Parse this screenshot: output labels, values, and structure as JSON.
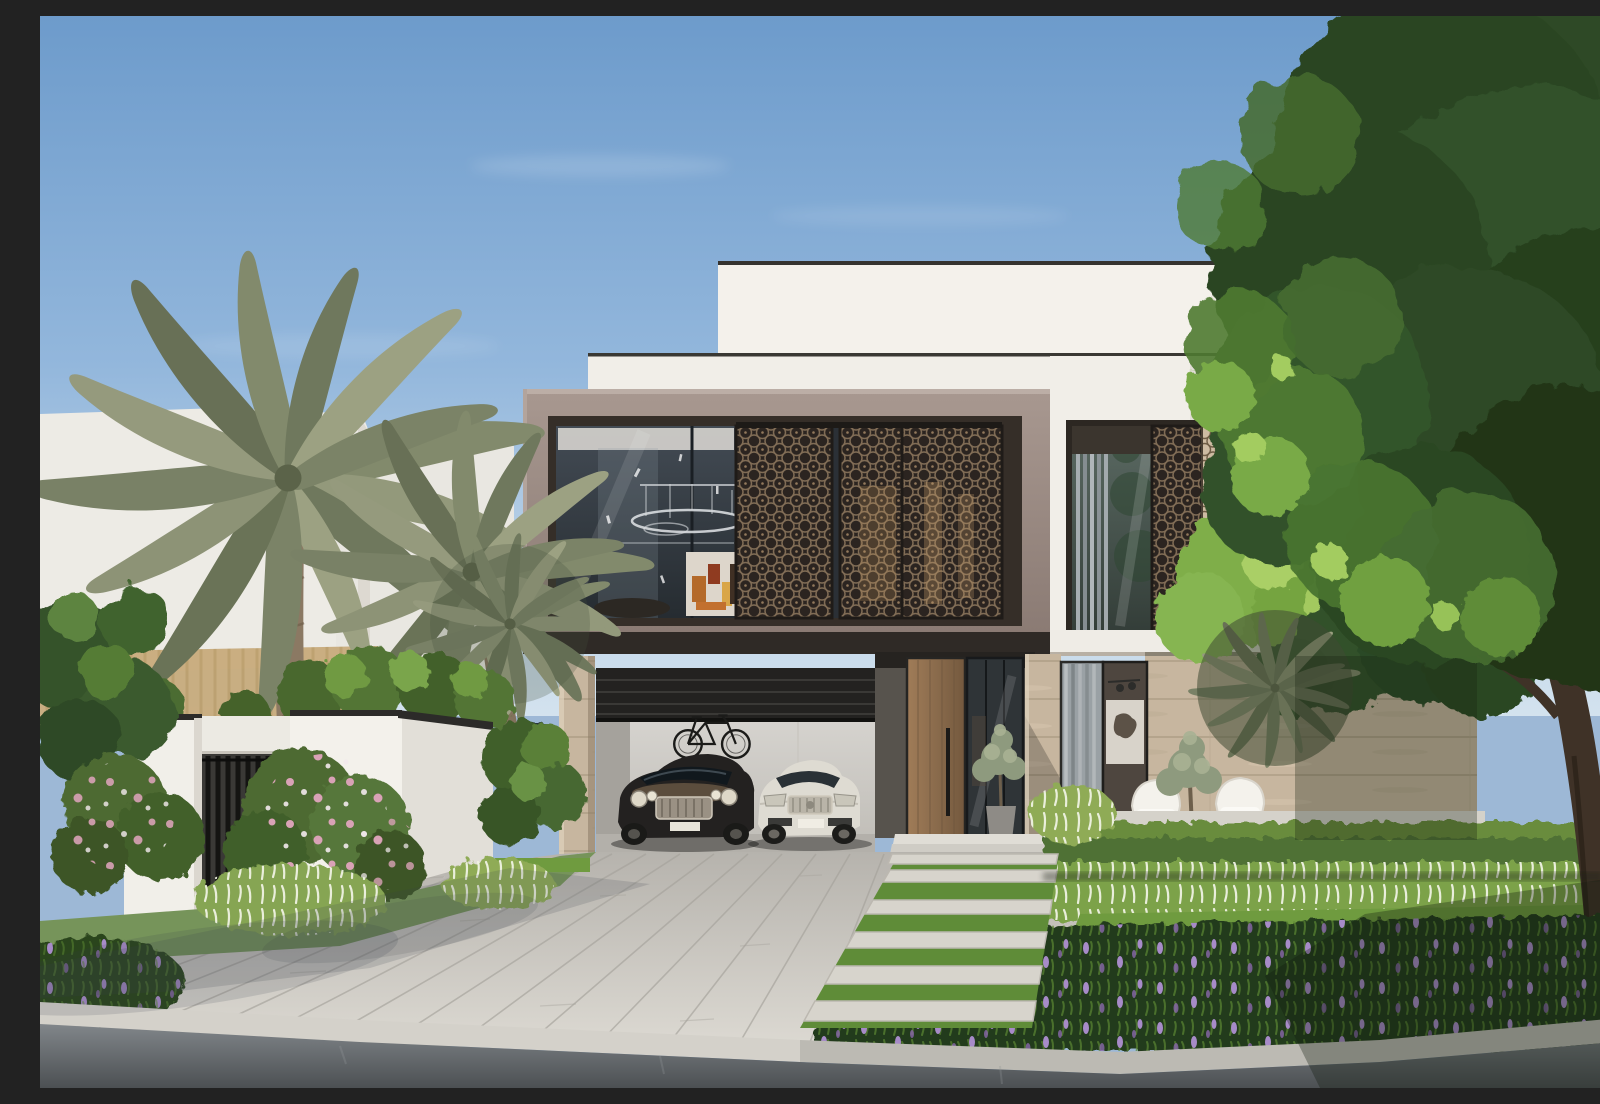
{
  "scene": {
    "type": "architectural-exterior-render",
    "title": "Modern two-storey villa with mashrabiya lattice screens, date palms and landscaped driveway under a clear blue sky",
    "time_of_day": "daytime",
    "weather": "clear with light wispy clouds"
  },
  "palette": {
    "sky_top": "#6d9bcb",
    "sky_horizon": "#d3e2ee",
    "villa_white": "#f3f0ea",
    "villa_taupe": "#9c8c85",
    "fascia_dark": "#2f2a26",
    "stone_beige": "#c7b69f",
    "wood_door": "#8a6b4c",
    "lattice_dark": "#2b2420",
    "lattice_bronze": "#806c55",
    "glass_upper": "#3c444c",
    "glass_lower": "#5b6a63",
    "palm_frond": "#828a6c",
    "palm_trunk": "#8b7963",
    "tree_dark": "#2e4a25",
    "tree_light": "#79aa47",
    "hedge_green": "#4f7134",
    "lawn_green": "#6f9b3f",
    "groundcover_green": "#243a1e",
    "plume_grass": "#7ba24a",
    "plume_white": "#f0f3e3",
    "flower_pink": "#d9a2b6",
    "flower_purple": "#a78bc8",
    "driveway_paving": "#cbc8c2",
    "road_asphalt": "#53575a",
    "car_dark": "#232120",
    "car_white": "#dedbd2"
  },
  "objects": {
    "villa": "two-storey flat-roof villa, white volumes over a taupe cantilevered box",
    "upper_window": "full-width glazing with chandelier and three sliding mashrabiya lattice panels",
    "right_window": "recessed glazing with grey curtains and sunlit lattice panel",
    "garage": "open double carport with dark shutter, two parked cars and wall-mounted bicycles",
    "entrance": "tall wood pivot door with black handle, glass sidelight and potted olive trees",
    "terrace": "two white wire chairs behind a trimmed hedge",
    "left_wall": "white gated compound wall with planter shrubs and black coping",
    "vegetation": "date palms, large leafy tree, pink oleander shrubs, fountain grass, purple-flowering groundcover",
    "hardscape": "plank-paved driveway, stepping-stone path with grass joints, concrete sidewalk, asphalt road"
  },
  "cars": [
    {
      "name": "dark luxury coupe",
      "color": "#232120"
    },
    {
      "name": "white luxury sedan",
      "color": "#dedbd2"
    }
  ]
}
